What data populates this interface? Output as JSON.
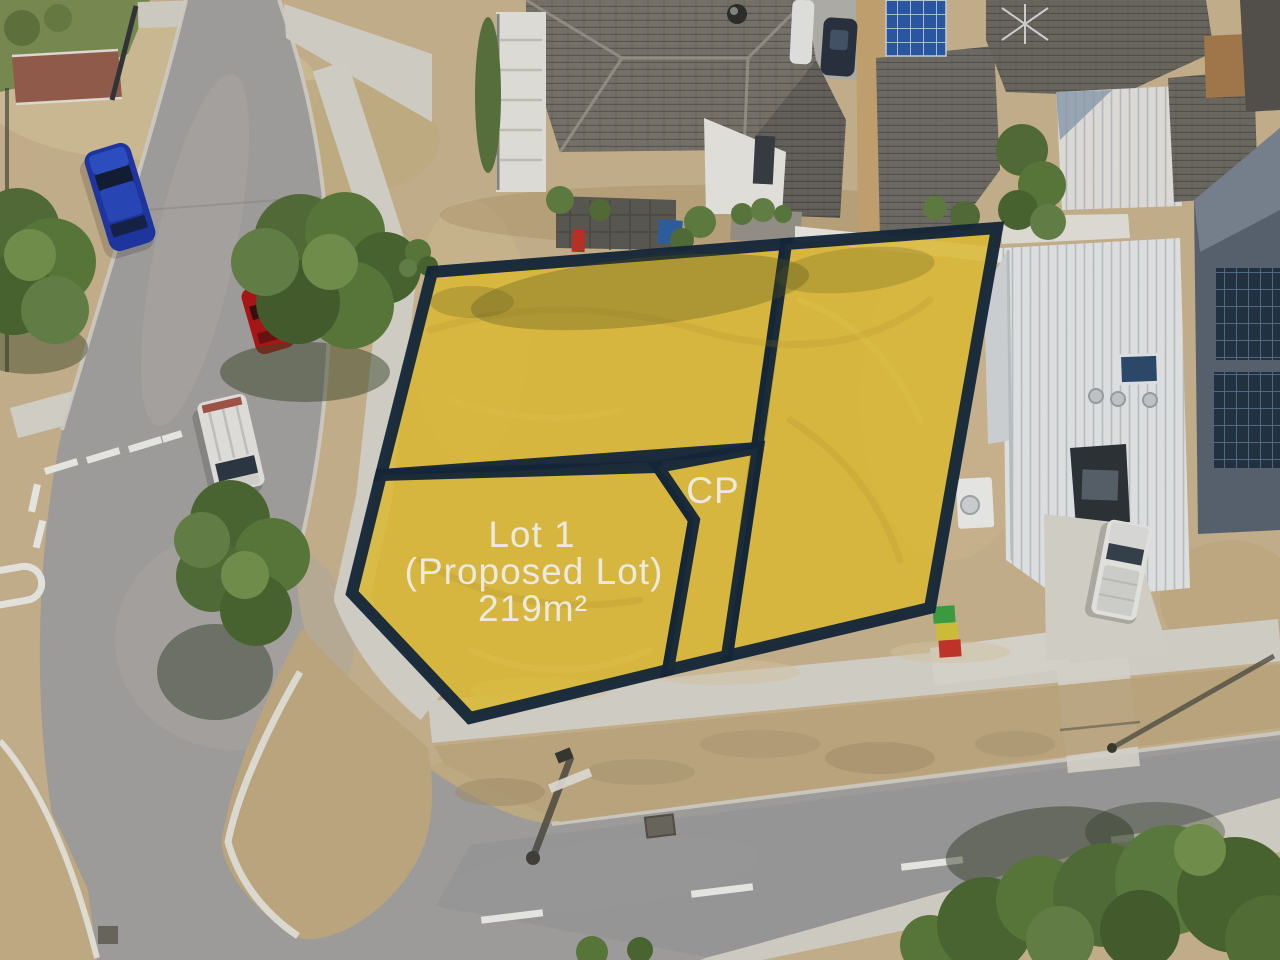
{
  "overlay": {
    "parcel_fill": "#E7C336",
    "boundary_color": "#16293C",
    "label_color": "#FAF7EC",
    "lot1": {
      "line1": "Lot 1",
      "line2": "(Proposed Lot)",
      "line3": "219m²"
    },
    "cp_label": "CP"
  }
}
